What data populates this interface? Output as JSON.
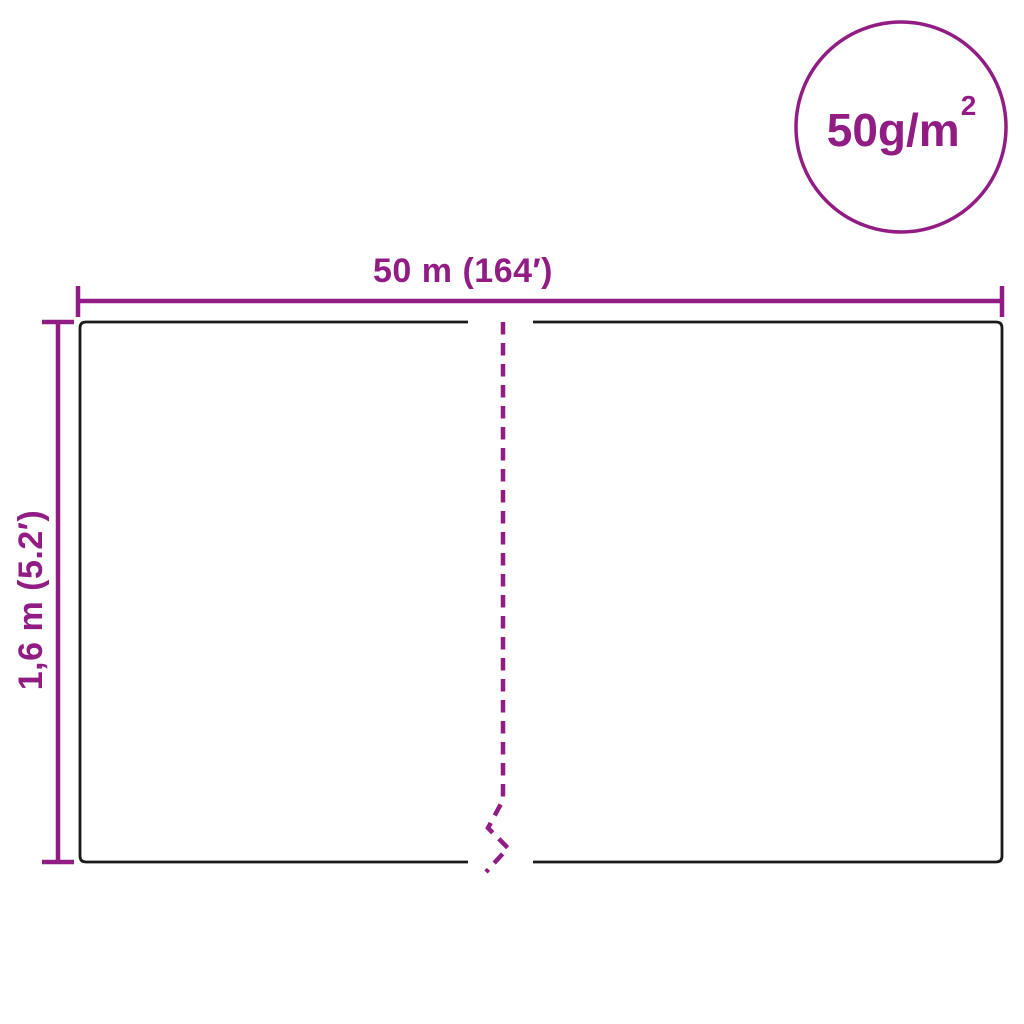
{
  "colors": {
    "accent": "#911C84",
    "outline": "#1A1A1A",
    "background": "#FFFFFF"
  },
  "badge": {
    "label": "50g/m",
    "superscript": "2"
  },
  "dimensions": {
    "width_label": "50 m (164′)",
    "height_label": "1,6 m (5.2′)"
  }
}
